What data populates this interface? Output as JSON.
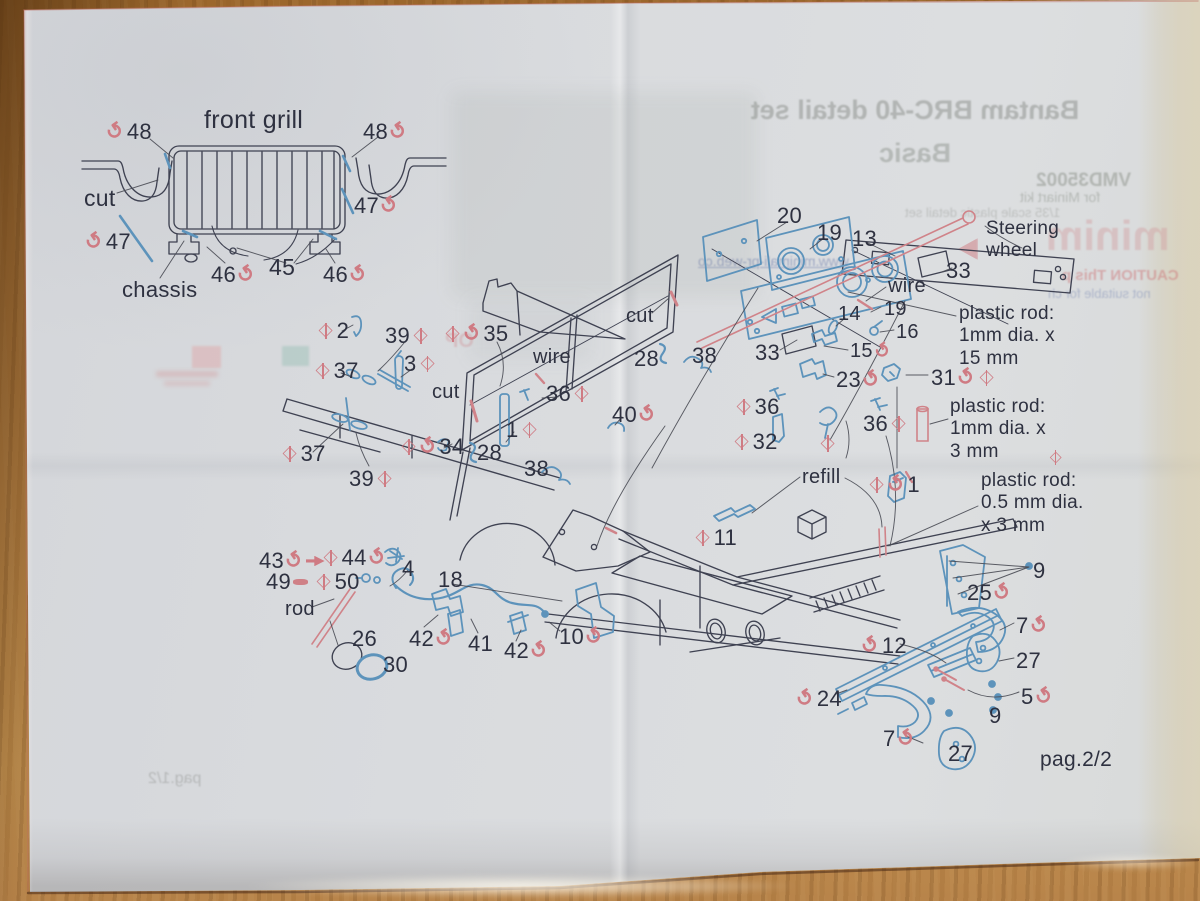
{
  "photo": {
    "surface": "wooden table",
    "wood_color": "#b5803f",
    "paper_color": "#d9dbdd"
  },
  "sheet": {
    "page_label": "pag.2/2",
    "colors": {
      "print_text": "#2e3140",
      "symbol_pink": "#cf7b83",
      "photoetch_blue": "#5d93bb",
      "resin_red": "#d08389",
      "line_dark": "#3f4252"
    },
    "symbol_key": {
      "b": "bend-arrow",
      "d": "drill-diamond",
      "dart": "dart-arrow",
      "pin": "rod-pin"
    },
    "labels": [
      {
        "x": 204,
        "y": 106,
        "s": 25,
        "n": "title-front-grill",
        "t": [
          "front grill"
        ]
      },
      {
        "x": 107,
        "y": 119,
        "t": [
          "b",
          "48"
        ]
      },
      {
        "x": 363,
        "y": 119,
        "t": [
          "48",
          "b"
        ]
      },
      {
        "x": 84,
        "y": 185,
        "s": 23,
        "t": [
          "cut"
        ]
      },
      {
        "x": 354,
        "y": 193,
        "t": [
          "47",
          "b"
        ]
      },
      {
        "x": 86,
        "y": 229,
        "t": [
          "b",
          "47"
        ]
      },
      {
        "x": 122,
        "y": 277,
        "t": [
          "chassis"
        ]
      },
      {
        "x": 211,
        "y": 262,
        "t": [
          "46",
          "b"
        ]
      },
      {
        "x": 269,
        "y": 254,
        "s": 23,
        "t": [
          "45"
        ]
      },
      {
        "x": 323,
        "y": 262,
        "t": [
          "46",
          "b"
        ]
      },
      {
        "x": 777,
        "y": 203,
        "t": [
          "20"
        ]
      },
      {
        "x": 817,
        "y": 220,
        "t": [
          "19"
        ]
      },
      {
        "x": 852,
        "y": 226,
        "t": [
          "13"
        ]
      },
      {
        "x": 946,
        "y": 258,
        "t": [
          "33"
        ]
      },
      {
        "x": 986,
        "y": 218,
        "s": 19,
        "n": "note-steering-wheel",
        "t": [
          "Steering\nwheel"
        ]
      },
      {
        "x": 888,
        "y": 275,
        "s": 20,
        "t": [
          "wire"
        ]
      },
      {
        "x": 884,
        "y": 298,
        "s": 20,
        "t": [
          "19"
        ]
      },
      {
        "x": 838,
        "y": 303,
        "s": 20,
        "t": [
          "14"
        ]
      },
      {
        "x": 896,
        "y": 321,
        "s": 20,
        "t": [
          "16"
        ]
      },
      {
        "x": 850,
        "y": 340,
        "s": 20,
        "t": [
          "15",
          "b"
        ]
      },
      {
        "x": 755,
        "y": 340,
        "t": [
          "33"
        ]
      },
      {
        "x": 959,
        "y": 303,
        "s": 19,
        "n": "note-plastic-rod-1x15",
        "t": [
          "plastic rod:\n1mm dia. x\n15 mm"
        ]
      },
      {
        "x": 836,
        "y": 367,
        "t": [
          "23",
          "b"
        ]
      },
      {
        "x": 931,
        "y": 365,
        "t": [
          "31",
          "b",
          "d"
        ]
      },
      {
        "x": 317,
        "y": 318,
        "t": [
          "d",
          "2"
        ]
      },
      {
        "x": 385,
        "y": 323,
        "t": [
          "39",
          "d"
        ]
      },
      {
        "x": 444,
        "y": 321,
        "t": [
          "d",
          "b",
          "35"
        ]
      },
      {
        "x": 314,
        "y": 358,
        "t": [
          "d",
          "37"
        ]
      },
      {
        "x": 404,
        "y": 351,
        "t": [
          "3",
          "d"
        ]
      },
      {
        "x": 432,
        "y": 381,
        "s": 20,
        "t": [
          "cut"
        ]
      },
      {
        "x": 533,
        "y": 346,
        "s": 20,
        "t": [
          "wire"
        ]
      },
      {
        "x": 546,
        "y": 381,
        "t": [
          "36",
          "d"
        ]
      },
      {
        "x": 626,
        "y": 305,
        "s": 20,
        "t": [
          "cut"
        ]
      },
      {
        "x": 634,
        "y": 346,
        "t": [
          "28"
        ]
      },
      {
        "x": 692,
        "y": 343,
        "t": [
          "38"
        ]
      },
      {
        "x": 612,
        "y": 402,
        "t": [
          "40",
          "b"
        ]
      },
      {
        "x": 506,
        "y": 417,
        "t": [
          "1",
          "d"
        ]
      },
      {
        "x": 400,
        "y": 434,
        "t": [
          "d",
          "b",
          "34"
        ]
      },
      {
        "x": 477,
        "y": 440,
        "t": [
          "28"
        ]
      },
      {
        "x": 524,
        "y": 456,
        "t": [
          "38"
        ]
      },
      {
        "x": 281,
        "y": 441,
        "t": [
          "d",
          "37"
        ]
      },
      {
        "x": 349,
        "y": 466,
        "t": [
          "39",
          "d"
        ]
      },
      {
        "x": 735,
        "y": 394,
        "t": [
          "d",
          "36"
        ]
      },
      {
        "x": 733,
        "y": 429,
        "t": [
          "d",
          "32"
        ]
      },
      {
        "x": 863,
        "y": 411,
        "t": [
          "36",
          "d"
        ]
      },
      {
        "x": 819,
        "y": 437,
        "t": [
          "d"
        ]
      },
      {
        "x": 802,
        "y": 466,
        "s": 20,
        "t": [
          "refill"
        ]
      },
      {
        "x": 868,
        "y": 472,
        "t": [
          "d",
          "b",
          "1"
        ]
      },
      {
        "x": 950,
        "y": 396,
        "s": 19,
        "va": "end",
        "n": "note-plastic-rod-1x3",
        "t": [
          "plastic rod:\n1mm dia. x\n3 mm ",
          "d"
        ]
      },
      {
        "x": 981,
        "y": 470,
        "s": 19,
        "n": "note-plastic-rod-05x3",
        "t": [
          "plastic rod:\n0.5 mm dia.\nx 3 mm"
        ]
      },
      {
        "x": 694,
        "y": 525,
        "t": [
          "d",
          "11"
        ]
      },
      {
        "x": 259,
        "y": 548,
        "t": [
          "43",
          "b",
          "dart"
        ]
      },
      {
        "x": 322,
        "y": 545,
        "t": [
          "d",
          "44",
          "b"
        ]
      },
      {
        "x": 266,
        "y": 569,
        "t": [
          "49",
          "pin"
        ]
      },
      {
        "x": 315,
        "y": 569,
        "t": [
          "d",
          "50"
        ]
      },
      {
        "x": 402,
        "y": 556,
        "t": [
          "4"
        ]
      },
      {
        "x": 438,
        "y": 567,
        "t": [
          "18"
        ]
      },
      {
        "x": 285,
        "y": 598,
        "s": 20,
        "t": [
          "rod"
        ]
      },
      {
        "x": 352,
        "y": 626,
        "t": [
          "26"
        ]
      },
      {
        "x": 383,
        "y": 652,
        "t": [
          "30"
        ]
      },
      {
        "x": 409,
        "y": 626,
        "t": [
          "42",
          "b"
        ]
      },
      {
        "x": 468,
        "y": 631,
        "t": [
          "41"
        ]
      },
      {
        "x": 504,
        "y": 638,
        "t": [
          "42",
          "b"
        ]
      },
      {
        "x": 559,
        "y": 624,
        "t": [
          "10",
          "b"
        ]
      },
      {
        "x": 1033,
        "y": 558,
        "t": [
          "9"
        ]
      },
      {
        "x": 967,
        "y": 580,
        "t": [
          "25",
          "b"
        ]
      },
      {
        "x": 1016,
        "y": 613,
        "t": [
          "7",
          "b"
        ]
      },
      {
        "x": 862,
        "y": 633,
        "t": [
          "b",
          "12"
        ]
      },
      {
        "x": 1016,
        "y": 648,
        "t": [
          "27"
        ]
      },
      {
        "x": 797,
        "y": 686,
        "t": [
          "b",
          "24"
        ]
      },
      {
        "x": 1021,
        "y": 684,
        "t": [
          "5",
          "b"
        ]
      },
      {
        "x": 989,
        "y": 703,
        "t": [
          "9"
        ]
      },
      {
        "x": 883,
        "y": 726,
        "t": [
          "7",
          "b"
        ]
      },
      {
        "x": 948,
        "y": 741,
        "t": [
          "27"
        ]
      },
      {
        "x": 1040,
        "y": 748,
        "s": 21,
        "n": "page-number",
        "t": [
          "pag.2/2"
        ]
      }
    ],
    "bleedthrough": {
      "texts": [
        {
          "x": 700,
          "y": 96,
          "w": 430,
          "align": "center",
          "size": 27,
          "weight": 700,
          "color": "rgba(150,154,150,0.60)",
          "text": "Bantam BRC-40 detail set"
        },
        {
          "x": 700,
          "y": 139,
          "w": 430,
          "align": "center",
          "size": 27,
          "weight": 700,
          "color": "rgba(150,154,150,0.55)",
          "text": "Basic"
        },
        {
          "x": 1036,
          "y": 171,
          "size": 19,
          "weight": 700,
          "color": "rgba(152,156,150,0.60)",
          "text": "VMD35002"
        },
        {
          "x": 1020,
          "y": 190,
          "size": 14,
          "weight": 400,
          "color": "rgba(152,156,150,0.55)",
          "text": "for Miniart kit"
        },
        {
          "x": 905,
          "y": 206,
          "size": 13,
          "weight": 400,
          "color": "rgba(155,158,152,0.45)",
          "text": "1/35 scale plastic detail set"
        },
        {
          "x": 698,
          "y": 254,
          "size": 14,
          "weight": 400,
          "color": "rgba(110,125,175,0.55)",
          "underline": true,
          "text": "www.minimali-pr-web.co"
        },
        {
          "x": 1046,
          "y": 213,
          "size": 42,
          "weight": 800,
          "color": "rgba(210,155,158,0.42)",
          "text": "minim"
        },
        {
          "x": 1062,
          "y": 268,
          "size": 15,
          "weight": 700,
          "color": "rgba(205,120,122,0.50)",
          "text": "CAUTION This p"
        },
        {
          "x": 1048,
          "y": 287,
          "size": 13,
          "weight": 400,
          "color": "rgba(120,135,180,0.45)",
          "text": "not suitable for ch"
        },
        {
          "x": 445,
          "y": 330,
          "size": 20,
          "weight": 700,
          "color": "rgba(210,150,155,0.40)",
          "text": "OP"
        },
        {
          "x": 148,
          "y": 770,
          "size": 16,
          "weight": 400,
          "color": "rgba(150,152,150,0.50)",
          "text": "pag.1/2"
        }
      ],
      "swatches": [
        {
          "x": 452,
          "y": 92,
          "w": 305,
          "h": 205,
          "color": "rgba(125,138,128,0.10)",
          "blur": 8,
          "r": 6
        },
        {
          "x": 470,
          "y": 300,
          "w": 120,
          "h": 60,
          "color": "rgba(130,140,135,0.08)",
          "blur": 8,
          "r": 6
        },
        {
          "x": 192,
          "y": 346,
          "w": 29,
          "h": 22,
          "color": "rgba(225,165,165,0.45)",
          "blur": 1,
          "r": 1
        },
        {
          "x": 282,
          "y": 346,
          "w": 27,
          "h": 20,
          "color": "rgba(150,190,180,0.45)",
          "blur": 1,
          "r": 1
        },
        {
          "x": 156,
          "y": 371,
          "w": 62,
          "h": 6,
          "color": "rgba(210,130,130,0.30)",
          "blur": 2,
          "r": 2
        },
        {
          "x": 164,
          "y": 381,
          "w": 46,
          "h": 5,
          "color": "rgba(210,130,130,0.25)",
          "blur": 2,
          "r": 2
        },
        {
          "x": 958,
          "y": 238,
          "w": 20,
          "h": 22,
          "color": "rgba(205,120,125,0.50)",
          "blur": 1,
          "tri": true
        }
      ]
    }
  }
}
